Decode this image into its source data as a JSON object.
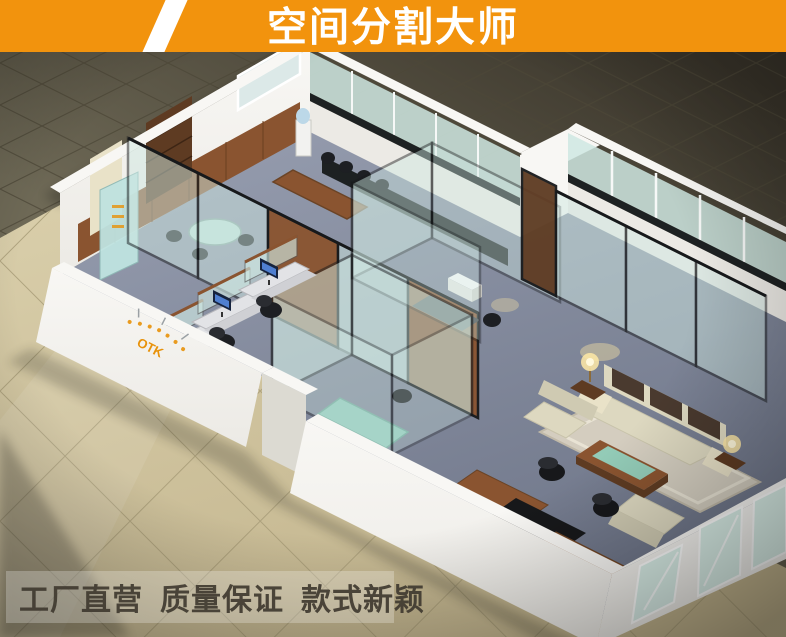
{
  "banner": {
    "title": "空间分割大师"
  },
  "footer": {
    "phrase_1": "工厂直营",
    "phrase_2": "质量保证",
    "phrase_3": "款式新颖"
  },
  "scene": {
    "wall_logo_text": "OTK"
  },
  "colors": {
    "banner_bg": "#f2930d",
    "banner_text": "#ffffff",
    "slash": "#ffffff",
    "floor_deep": "#39342a",
    "floor_dark": "#6e6956",
    "tile_line_dark": "#4c4736",
    "floor_beige": "#d8cda9",
    "floor_beige_dark": "#c2b48d",
    "tile_line_beige": "#a89c78",
    "wall": "#eceae5",
    "wall_bright": "#f8f7f4",
    "wall_shade": "#dcdad2",
    "carpet": "#959cae",
    "carpet_dark": "#6d7487",
    "glass": "#cfe8e2",
    "frame": "#17191b",
    "mullion": "#f6f8f7",
    "wood": "#8a5430",
    "wood_dark": "#5e3b22",
    "marble": "#1d2122",
    "cream": "#e9e2c8",
    "sofa": "#ddd8c0",
    "cushion": "#4a3a2f",
    "table_glass": "#93d2bf",
    "lamp": "#ffe9a6",
    "logo": "#e8920a",
    "footer_text": "#403a30",
    "footer_box": "rgba(255,255,255,0.25)"
  }
}
